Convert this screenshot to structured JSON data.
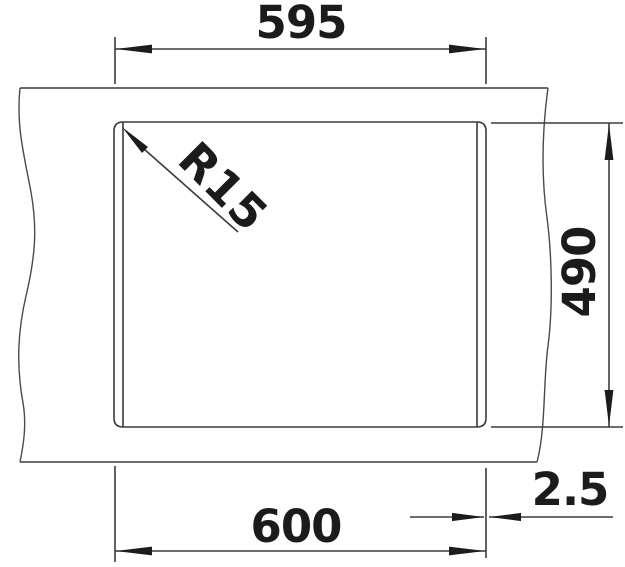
{
  "drawing": {
    "dimensions": {
      "top_width": "595",
      "bottom_width": "600",
      "right_height": "490",
      "edge_offset": "2.5",
      "corner_radius": "R15"
    },
    "colors": {
      "line": "#3b3b3b",
      "text": "#1b1b1b",
      "background": "#ffffff"
    }
  }
}
